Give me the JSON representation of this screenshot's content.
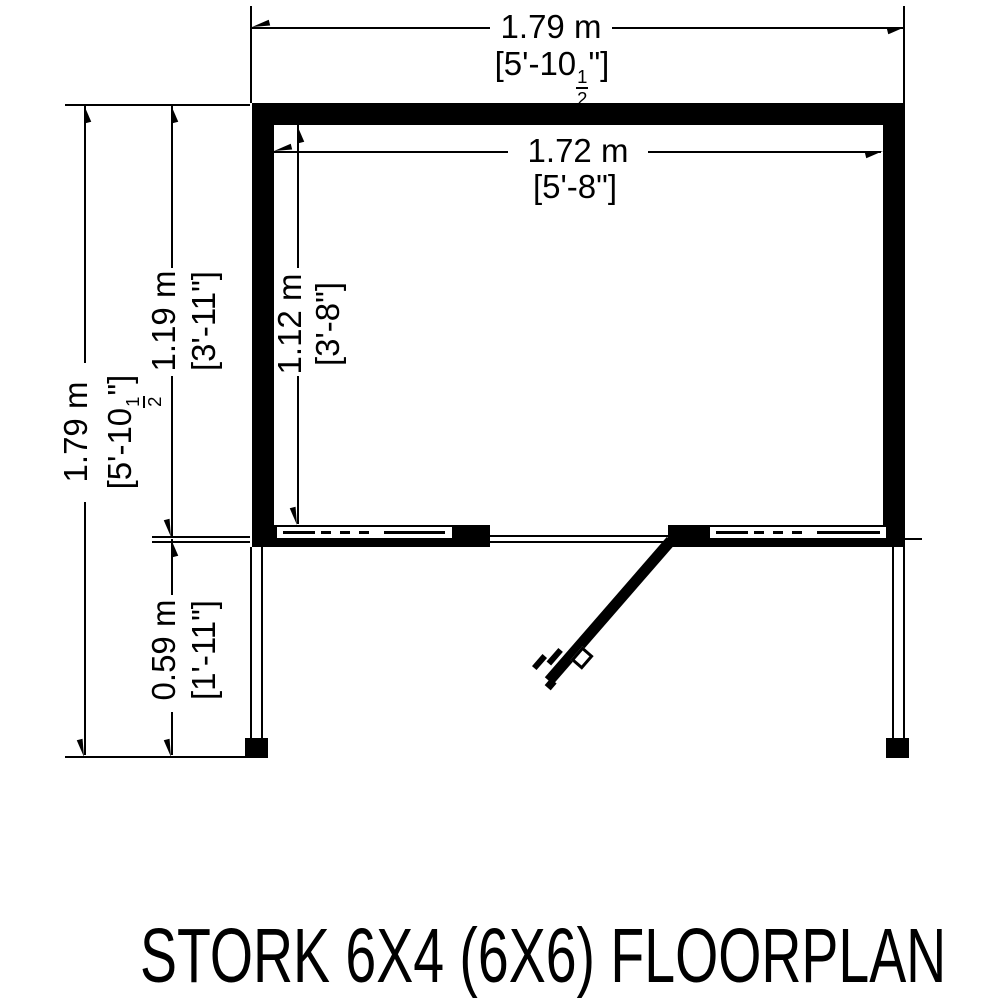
{
  "title": "STORK 6X4 (6X6) FLOORPLAN",
  "colors": {
    "line": "#000000",
    "background": "#ffffff"
  },
  "dimensions": {
    "width_overall": {
      "metric": "1.79 m",
      "imperial_pre": "[5'-10",
      "frac_num": "1",
      "frac_den": "2",
      "imperial_post": "\"]"
    },
    "width_internal": {
      "metric": "1.72 m",
      "imperial": "[5'-8\"]"
    },
    "depth_overall": {
      "metric": "1.79 m",
      "imperial_pre": "[5'-10",
      "frac_num": "1",
      "frac_den": "2",
      "imperial_post": "\"]"
    },
    "depth_main": {
      "metric": "1.19 m",
      "imperial": "[3'-11\"]"
    },
    "depth_internal": {
      "metric": "1.12 m",
      "imperial": "[3'-8\"]"
    },
    "depth_porch": {
      "metric": "0.59 m",
      "imperial": "[1'-11\"]"
    }
  }
}
